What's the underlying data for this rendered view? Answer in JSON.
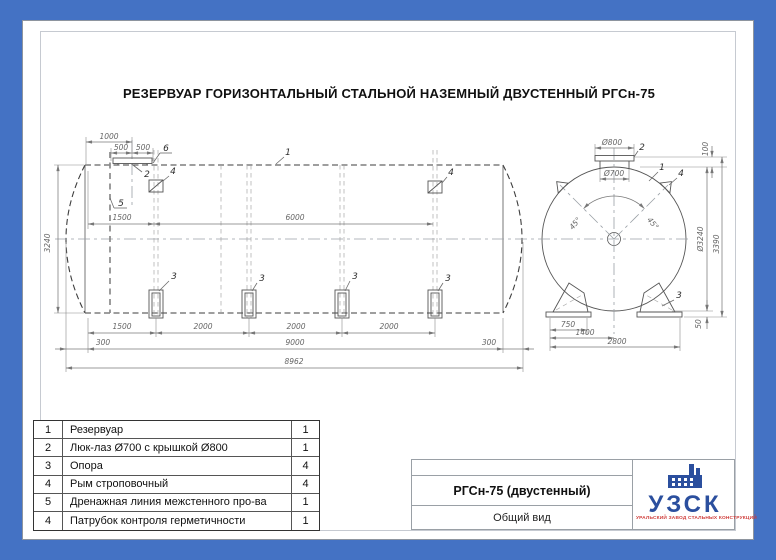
{
  "page": {
    "title": "РЕЗЕРВУАР ГОРИЗОНТАЛЬНЫЙ СТАЛЬНОЙ НАЗЕМНЫЙ ДВУСТЕННЫЙ РГСн-75"
  },
  "side_view": {
    "dims": {
      "top_1000": "1000",
      "top_500_left": "500",
      "top_500_right": "500",
      "mid_1500": "1500",
      "mid_6000": "6000",
      "left_3240": "3240",
      "bottom_1500": "1500",
      "bottom_2000": "2000",
      "bottom_300_left": "300",
      "bottom_9000": "9000",
      "bottom_300_right": "300",
      "bottom_8962": "8962"
    },
    "callouts": {
      "shell": "1",
      "manhole": "2",
      "support": "3",
      "lifting_lug": "4",
      "drain_line": "5",
      "control_nozzle": "6"
    }
  },
  "end_view": {
    "dims": {
      "dia_800": "Ø800",
      "dia_700": "Ø700",
      "top_100": "100",
      "dia_3240": "Ø3240",
      "height_3390": "3390",
      "bottom_50": "50",
      "base_750": "750",
      "base_1400": "1400",
      "base_2800": "2800",
      "angle_left": "45°",
      "angle_right": "45°"
    },
    "callouts": {
      "shell": "1",
      "manhole": "2",
      "support": "3",
      "lifting_lug": "4"
    }
  },
  "parts_table": {
    "rows": [
      {
        "pos": "1",
        "name": "Резервуар",
        "qty": "1"
      },
      {
        "pos": "2",
        "name": "Люк-лаз Ø700 с крышкой Ø800",
        "qty": "1"
      },
      {
        "pos": "3",
        "name": "Опора",
        "qty": "4"
      },
      {
        "pos": "4",
        "name": "Рым строповочный",
        "qty": "4"
      },
      {
        "pos": "5",
        "name": "Дренажная линия межстенного про-ва",
        "qty": "1"
      },
      {
        "pos": "4",
        "name": "Патрубок контроля герметичности",
        "qty": "1"
      }
    ]
  },
  "title_block": {
    "model": "РГСн-75 (двустенный)",
    "view_name": "Общий вид"
  },
  "logo": {
    "name": "УЗСК",
    "tagline": "УРАЛЬСКИЙ ЗАВОД СТАЛЬНЫХ КОНСТРУКЦИЙ"
  },
  "colors": {
    "frame_blue": "#4472c4",
    "logo_blue": "#2b4f9e",
    "logo_red": "#cf3b38",
    "line_gray": "#3d3d3d"
  }
}
